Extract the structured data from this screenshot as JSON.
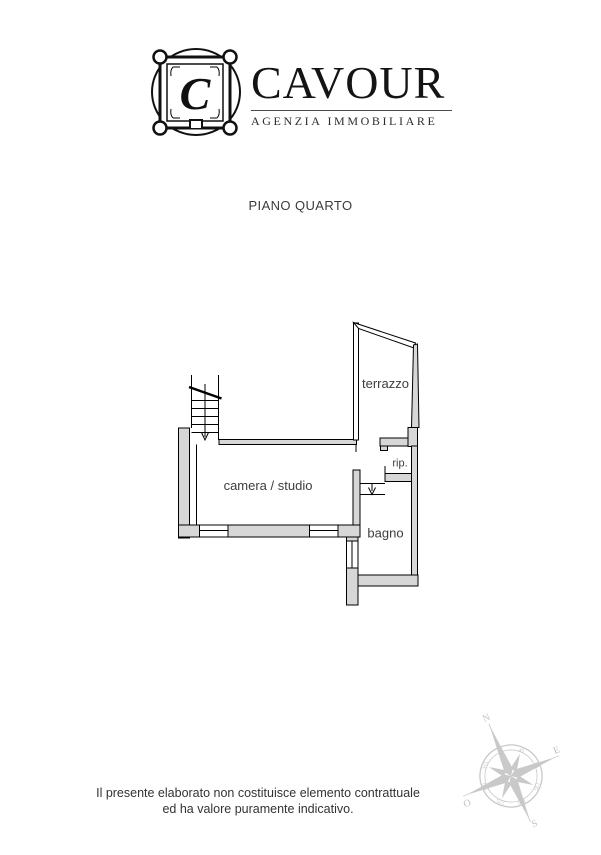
{
  "header": {
    "brand": "CAVOUR",
    "subtitle": "AGENZIA IMMOBILIARE",
    "emblem_letter": "C"
  },
  "title": "PIANO QUARTO",
  "plan": {
    "rooms": [
      {
        "label": "terrazzo"
      },
      {
        "label": "rip."
      },
      {
        "label": "camera / studio"
      },
      {
        "label": "bagno"
      }
    ],
    "wall_color": "#d7d7d7",
    "line_color": "#000000",
    "label_color": "#3d3d3d"
  },
  "compass": {
    "north": "N",
    "east": "E",
    "south": "S",
    "west": "O",
    "degrees": [
      "45",
      "90",
      "135",
      "180",
      "225",
      "270",
      "315"
    ],
    "color": "#c9c9c9"
  },
  "footer": {
    "line1": "Il presente elaborato non costituisce elemento contrattuale",
    "line2": "ed ha valore puramente indicativo."
  }
}
